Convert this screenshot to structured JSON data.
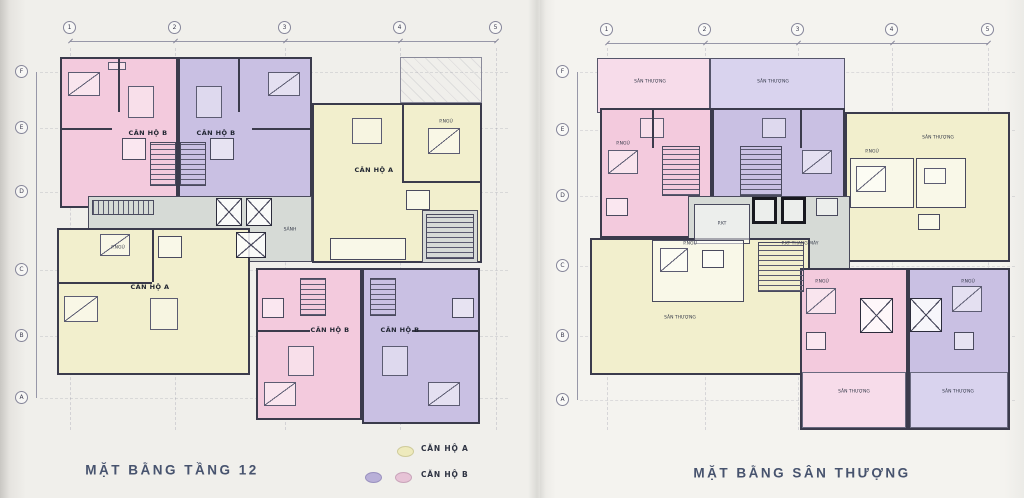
{
  "scan": {
    "description": "Scanned architectural drawing sheet with two apartment floor plans side by side",
    "paper_color_left": "#f0efeb",
    "paper_color_right": "#f4f3ef"
  },
  "colors": {
    "apartment_a_yellow": "#f2efcd",
    "apartment_b_purple": "#c9c0e3",
    "apartment_b_pink": "#f3cadd",
    "terrace_pink_pale": "#f7dcea",
    "terrace_purple_pale": "#d9d3ee",
    "corridor_gray": "#d6dad6",
    "wall_ink": "#3b3b4c",
    "title_ink": "#47536e"
  },
  "left_plan": {
    "title": "MẶT BẰNG TẦNG 12",
    "grid_columns": [
      "1",
      "2",
      "3",
      "4",
      "5"
    ],
    "grid_rows": [
      "F",
      "E",
      "D",
      "C",
      "B",
      "A"
    ],
    "units": {
      "top_pink": "CĂN HỘ B",
      "top_purple": "CĂN HỘ B",
      "right_yellow": "CĂN HỘ A",
      "bottom_yellow": "CĂN HỘ A",
      "bottom_pink": "CĂN HỘ B",
      "bottom_purple": "CĂN HỘ B"
    },
    "labels": {
      "lobby": "SẢNH",
      "bedroom": "P.NGỦ"
    }
  },
  "right_plan": {
    "title": "MẶT BẰNG SÂN THƯỢNG",
    "grid_columns": [
      "1",
      "2",
      "3",
      "4",
      "5"
    ],
    "grid_rows": [
      "F",
      "E",
      "D",
      "C",
      "B",
      "A"
    ],
    "labels": {
      "terrace": "SÂN THƯỢNG",
      "machine_room": "P.KT THANG MÁY",
      "tech_room": "P.KT",
      "bedroom": "P.NGỦ"
    }
  },
  "legend": {
    "rows": [
      {
        "label": "CĂN HỘ A"
      },
      {
        "label": "CĂN HỘ B"
      }
    ]
  }
}
